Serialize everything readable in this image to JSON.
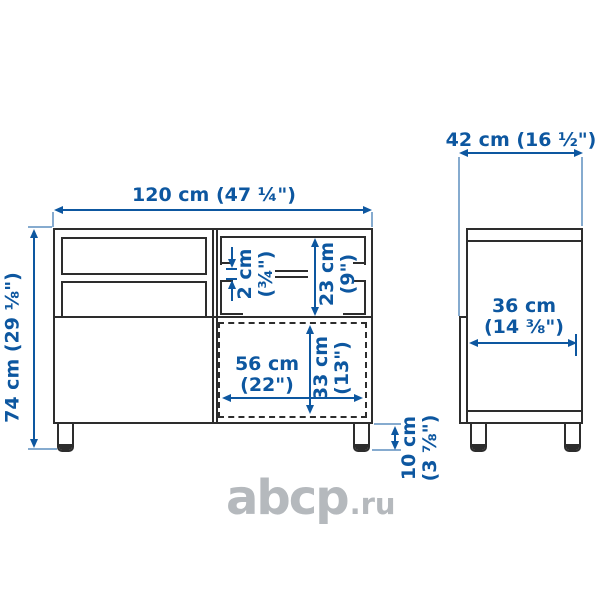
{
  "colors": {
    "line": "#2d2d2d",
    "dimension": "#0d57a0",
    "watermark": "#b5b9bd",
    "background": "#ffffff"
  },
  "front": {
    "width": {
      "label": "120 cm (47 ¼\")"
    },
    "height": {
      "label": "74 cm (29 ⅛\")"
    },
    "shelf_thickness": {
      "cm": "2 cm",
      "inch": "(¾\")"
    },
    "compartment_height": {
      "cm": "23 cm",
      "inch": "(9\")"
    },
    "opening_width": {
      "cm": "56 cm",
      "inch": "(22\")"
    },
    "opening_height": {
      "cm": "33 cm",
      "inch": "(13\")"
    },
    "leg_height": {
      "cm": "10 cm",
      "inch": "(3 ⅞\")"
    }
  },
  "side": {
    "depth": {
      "label": "42 cm (16 ½\")"
    },
    "inner_depth": {
      "cm": "36 cm",
      "inch": "(14 ⅜\")"
    }
  },
  "watermark": {
    "brand": "abcp",
    "suffix": ".ru"
  }
}
